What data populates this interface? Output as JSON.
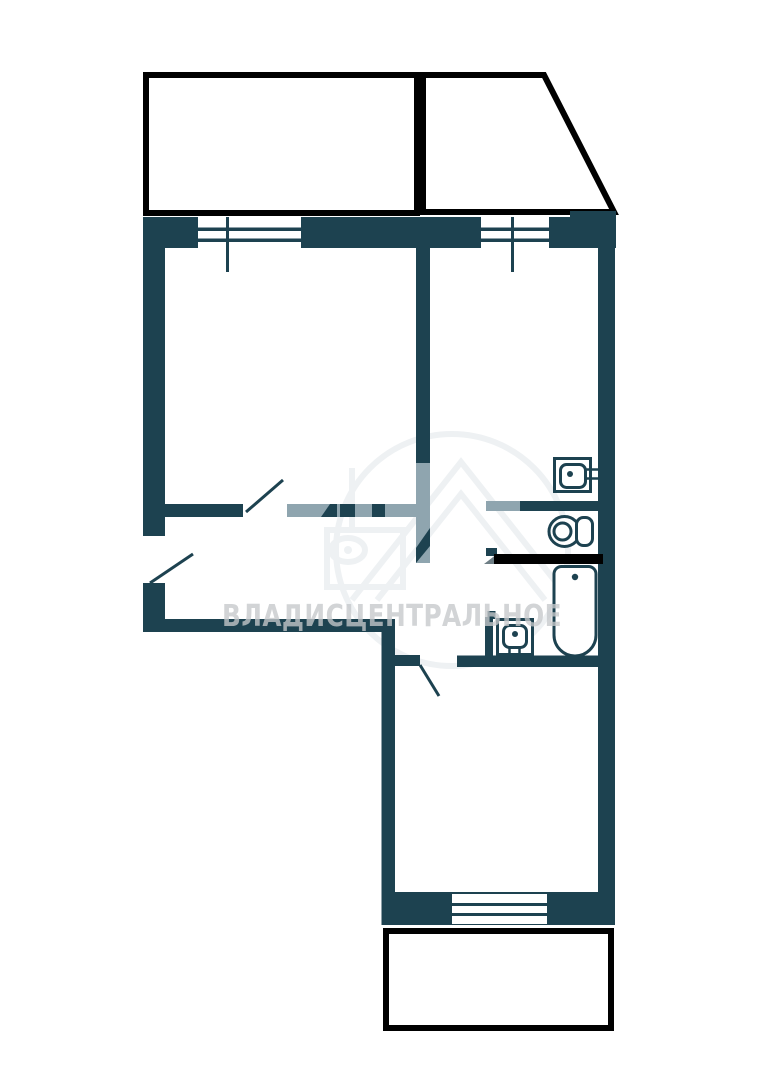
{
  "title": "apartment-floor-plan",
  "watermark": {
    "text": "ВЛАДИСЦЕНТРАЛЬНОЕ"
  },
  "colors": {
    "wall": "#1d4250",
    "light_partition": "#8fa5af",
    "balcony_outline": "#000000",
    "removed_wall": "#000000",
    "wedge": "#6e7e85",
    "watermark_text": "rgba(197,200,203,0.78)",
    "watermark_logo": "#eef1f3",
    "background": "#ffffff"
  },
  "elements": {
    "balconies": [
      "top-left-balcony",
      "top-right-balcony-angled",
      "bottom-balcony"
    ],
    "windows": [
      "living-room-window",
      "kitchen-window",
      "bedroom-window"
    ],
    "door_swings": [
      "entry-door",
      "living-room-door",
      "bedroom-door"
    ],
    "fixtures": [
      "kitchen-sink",
      "toilet",
      "bathtub",
      "washbasin"
    ]
  }
}
